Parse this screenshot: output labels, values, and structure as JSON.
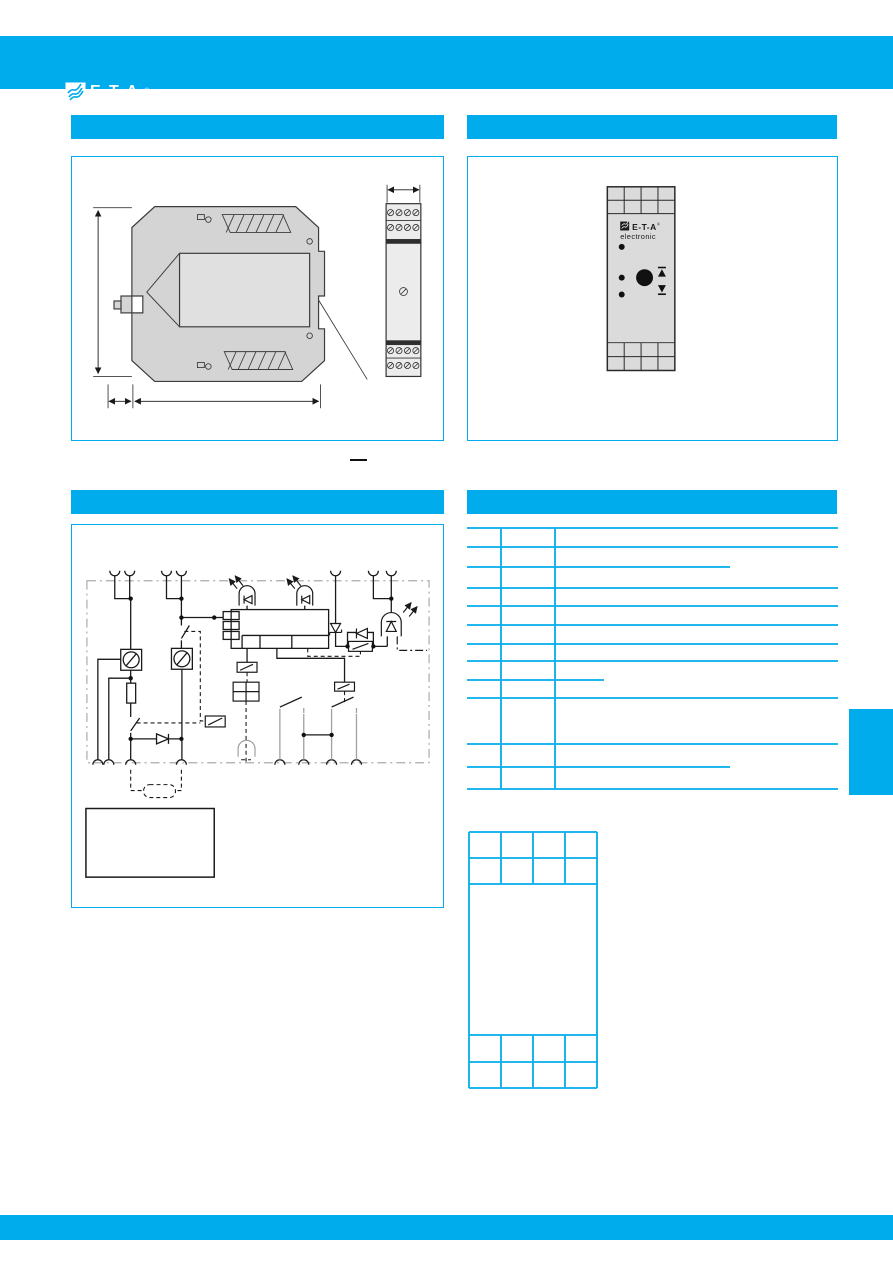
{
  "header": {
    "logo_text": "E-T-A",
    "registered_mark": "®"
  },
  "colors": {
    "brand_cyan": "#00ACEC",
    "housing_grey": "#D4D4D4",
    "drawing_line": "#3D3D3D",
    "circuit_line": "#1A1A1A",
    "circuit_grey": "#A0A0A0"
  },
  "sections": [
    {
      "id": "top-left",
      "label": ""
    },
    {
      "id": "top-right",
      "label": ""
    },
    {
      "id": "mid-left",
      "label": ""
    },
    {
      "id": "mid-right",
      "label": ""
    }
  ],
  "device_front": {
    "brand": "E-T-A",
    "registered_mark": "®",
    "brand_sub": "electronic",
    "led_count": 3,
    "terminal_cols": 4,
    "terminal_rows_top": 2,
    "terminal_rows_bottom": 2
  },
  "terminals_table": {
    "left": 467,
    "right": 838,
    "top": 528,
    "bottom": 789,
    "column_lines_x": [
      501,
      555
    ],
    "row_lines_y": [
      528,
      547,
      588,
      606,
      625,
      644,
      661,
      698,
      744,
      789
    ],
    "partial_row_lines": [
      {
        "y": 567,
        "x1": 467,
        "x2": 730
      },
      {
        "y": 680,
        "x1": 467,
        "x2": 604
      },
      {
        "y": 767,
        "x1": 467,
        "x2": 730
      }
    ],
    "columns": [
      "",
      "",
      ""
    ],
    "rows": [
      [
        "",
        "",
        ""
      ],
      [
        "",
        "",
        ""
      ],
      [
        "",
        "",
        ""
      ],
      [
        "",
        "",
        ""
      ],
      [
        "",
        "",
        ""
      ],
      [
        "",
        "",
        ""
      ],
      [
        "",
        "",
        ""
      ],
      [
        "",
        "",
        ""
      ],
      [
        "",
        "",
        ""
      ]
    ]
  },
  "ordering_table": {
    "left": 469,
    "right": 597,
    "top": 832,
    "bottom": 1088,
    "row_lines_y": [
      858,
      884,
      1035,
      1062
    ],
    "column_lines_x": [
      501,
      533,
      565
    ],
    "column_line_spans": [
      [
        832,
        884
      ],
      [
        1035,
        1088
      ]
    ],
    "cells": ""
  }
}
